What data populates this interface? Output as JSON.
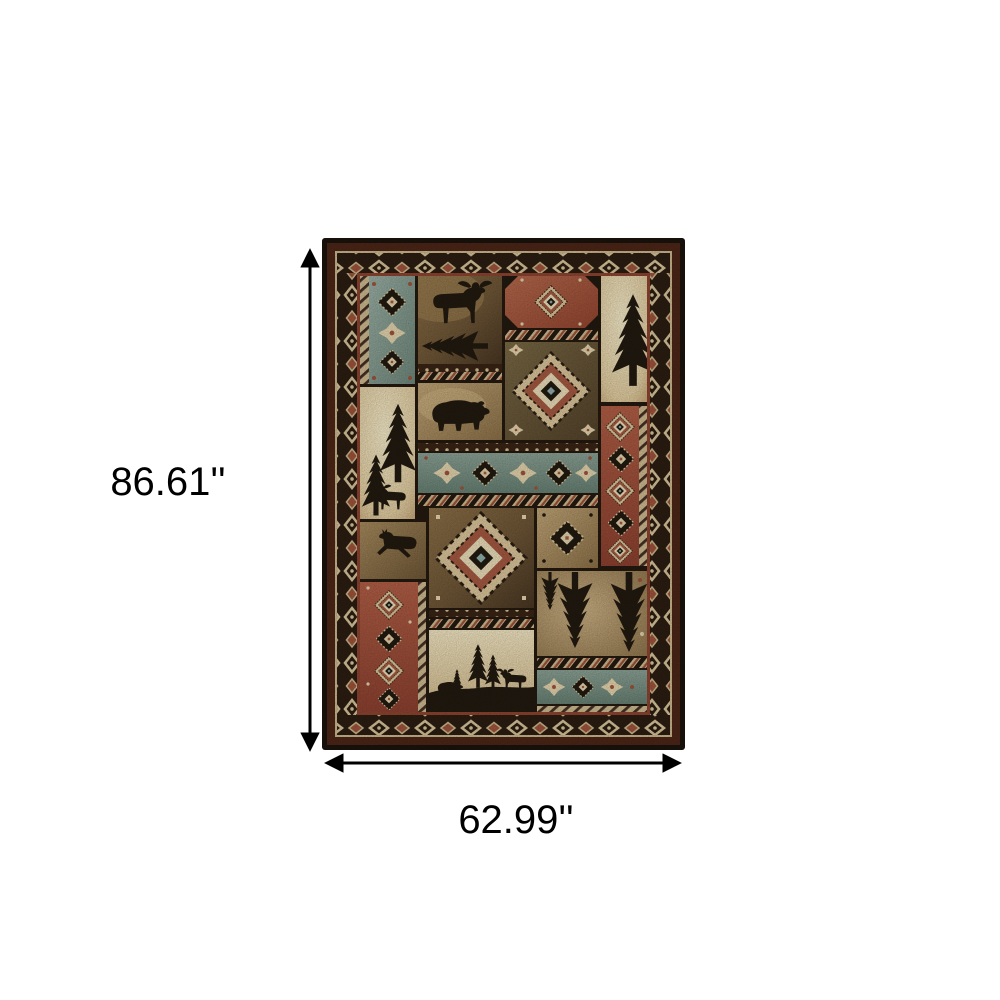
{
  "figure": {
    "type": "product-dimensions-diagram",
    "background": "#ffffff"
  },
  "annotation": {
    "height_label": "86.61''",
    "width_label": "62.99''",
    "unit": "inches",
    "line_color": "#000000"
  },
  "rug": {
    "description": "rustic lodge patchwork area rug",
    "motifs": [
      "moose-silhouette",
      "bear-silhouette",
      "deer-silhouette",
      "pine-tree-silhouette",
      "southwest-diamond-medallion",
      "rope-stripe-divider",
      "diamond-border-band"
    ],
    "palette": {
      "outer_border": "#1b130d",
      "border_maroon": "#4e2618",
      "border_band": "#2c1e12",
      "border_cream": "#d9c69c",
      "rust": "#a65a42",
      "rust_dark": "#8f4430",
      "slate_blue": "#8ba39d",
      "cream": "#e9d8b2",
      "tan": "#a58a5e",
      "brown": "#6e5636",
      "olive": "#6f5f3e",
      "silhouette": "#221a10"
    }
  }
}
